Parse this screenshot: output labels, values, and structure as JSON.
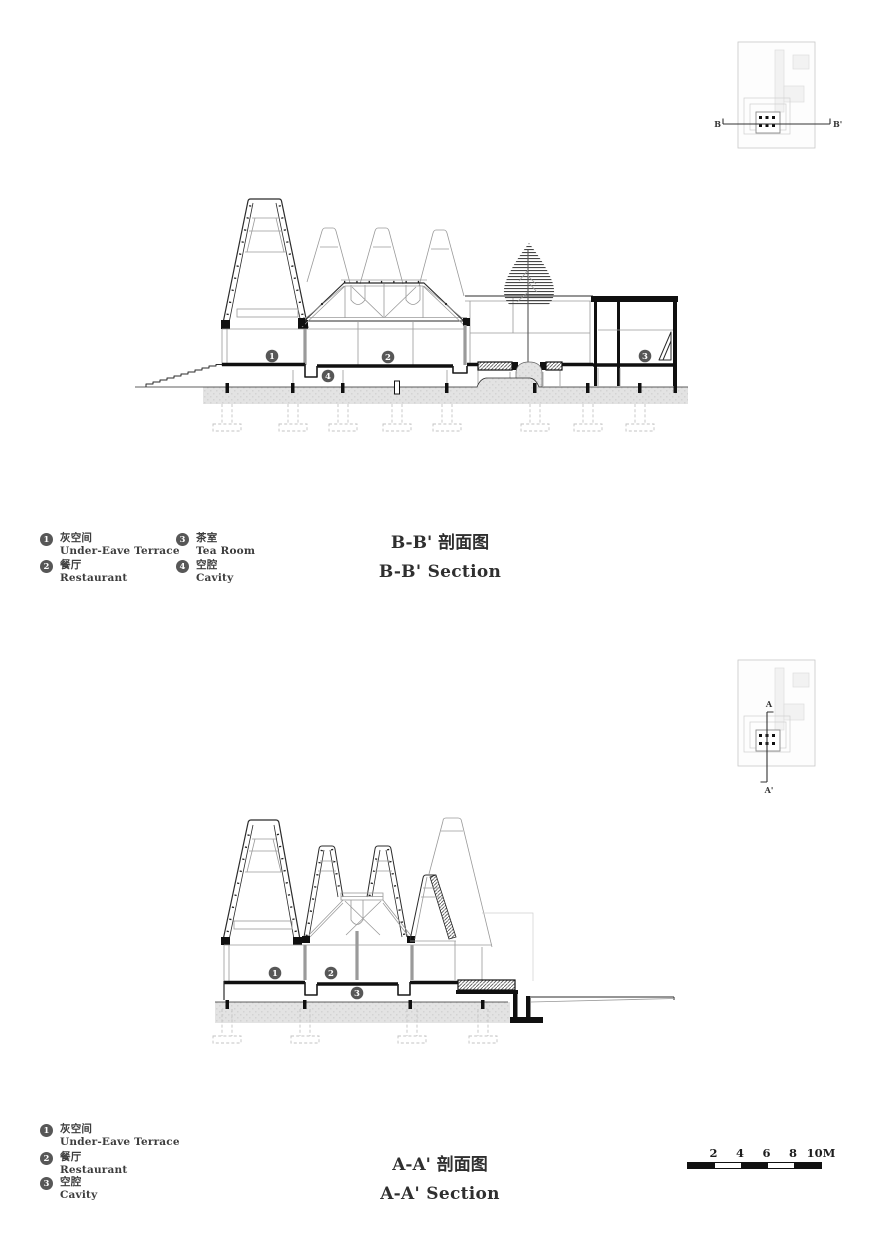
{
  "colors": {
    "ink": "#2b2b2b",
    "light_line": "#9a9a9a",
    "ground_fill": "#e3e3e3",
    "bubble_fill": "#575757",
    "black": "#111111"
  },
  "sections": {
    "bb": {
      "title_zh": "B-B' 剖面图",
      "title_en": "B-B' Section",
      "key_plan": {
        "start": "B",
        "end": "B'"
      },
      "legend": [
        {
          "num": "1",
          "zh": "灰空间",
          "en": "Under-Eave Terrace"
        },
        {
          "num": "2",
          "zh": "餐厅",
          "en": "Restaurant"
        },
        {
          "num": "3",
          "zh": "茶室",
          "en": "Tea Room"
        },
        {
          "num": "4",
          "zh": "空腔",
          "en": "Cavity"
        }
      ]
    },
    "aa": {
      "title_zh": "A-A' 剖面图",
      "title_en": "A-A' Section",
      "key_plan": {
        "start": "A",
        "end": "A'"
      },
      "legend": [
        {
          "num": "1",
          "zh": "灰空间",
          "en": "Under-Eave Terrace"
        },
        {
          "num": "2",
          "zh": "餐厅",
          "en": "Restaurant"
        },
        {
          "num": "3",
          "zh": "空腔",
          "en": "Cavity"
        }
      ]
    }
  },
  "scale_bar": {
    "labels": [
      "2",
      "4",
      "6",
      "8",
      "10M"
    ]
  }
}
